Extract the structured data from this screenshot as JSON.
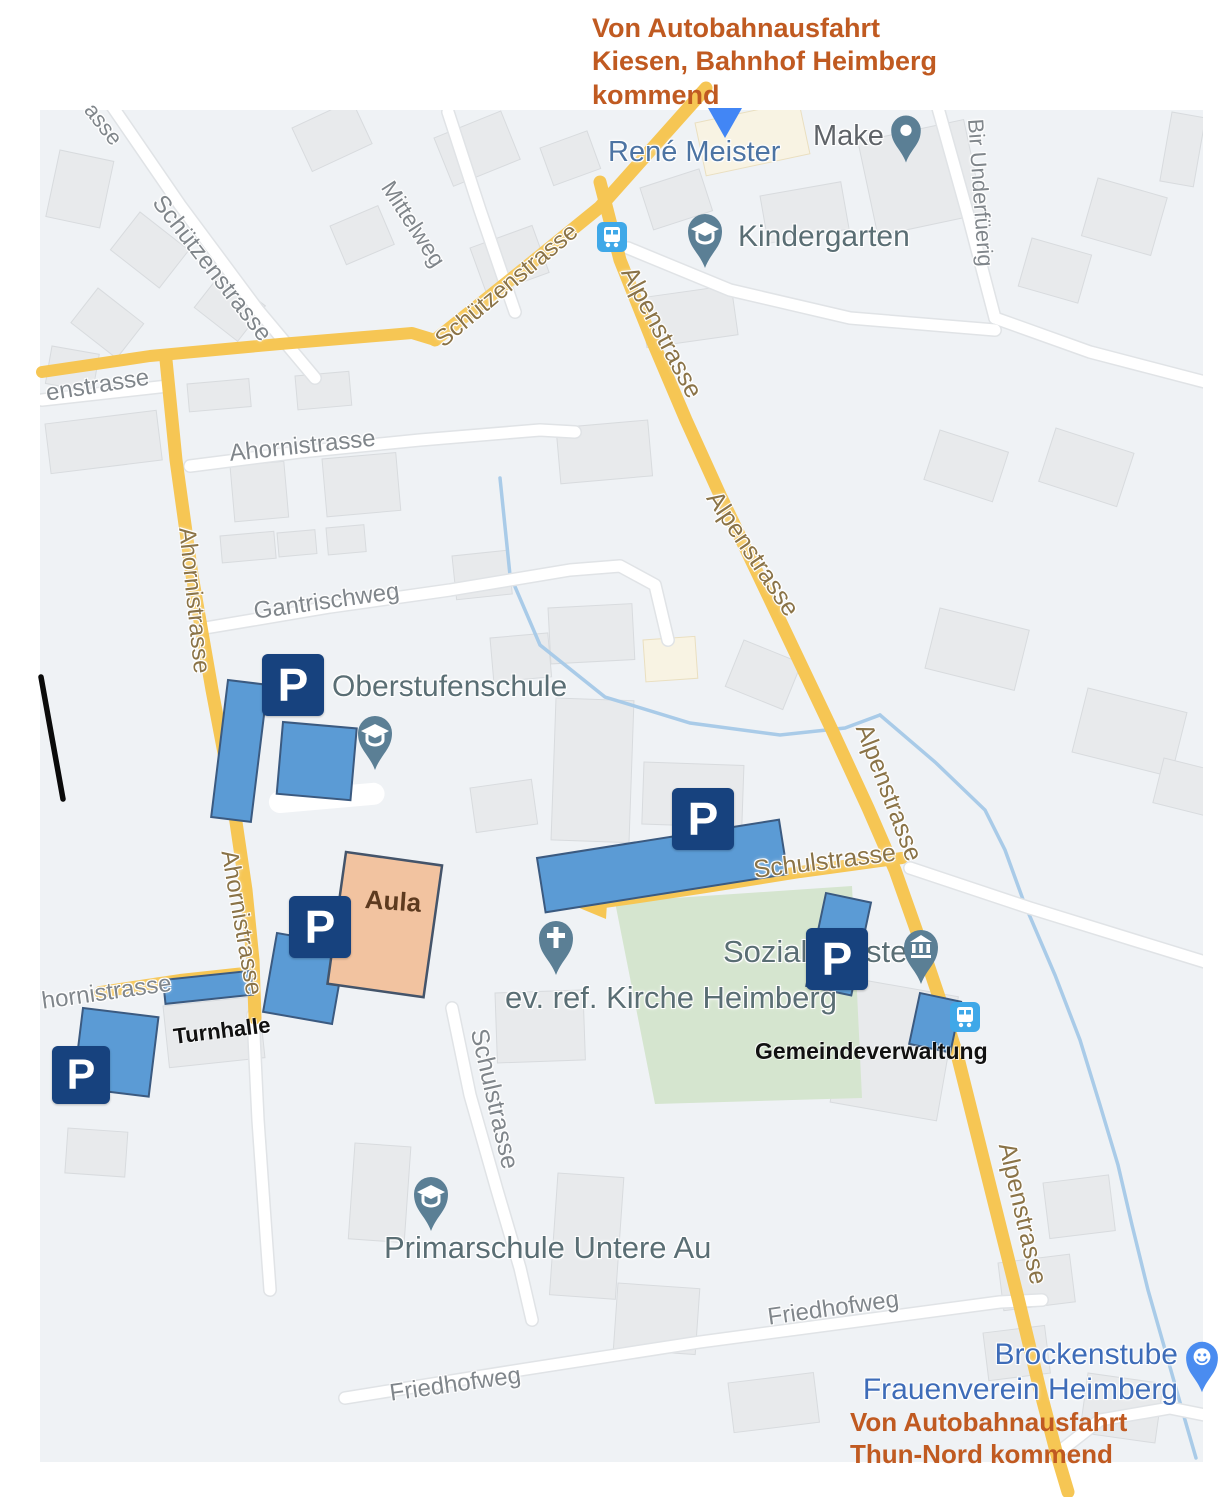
{
  "annotations": {
    "from_kiesen": {
      "lines": [
        "Von Autobahnausfahrt",
        "Kiesen, Bahnhof Heimberg",
        "kommend"
      ]
    },
    "from_thun": {
      "lines": [
        "Von Autobahnausfahrt",
        "Thun-Nord kommend"
      ]
    },
    "aula": "Aula",
    "turnhalle": "Turnhalle",
    "gemeindeverwaltung": "Gemeindeverwaltung",
    "parking_symbol": "P"
  },
  "streets": {
    "schuetzenstrasse": "Schützenstrasse",
    "mittelweg": "Mittelweg",
    "bir_underfuerig": "Bir Underfüerig",
    "ahornistrasse": "Ahornistrasse",
    "ahornistrasse_partial": "hornistrasse",
    "enstrasse_partial": "enstrasse",
    "asse_partial": "asse",
    "gantrischweg": "Gantrischweg",
    "alpenstrasse": "Alpenstrasse",
    "schulstrasse": "Schulstrasse",
    "friedhofweg": "Friedhofweg"
  },
  "places": {
    "rene_meister": "René Meister",
    "make": "Make",
    "kindergarten": "Kindergarten",
    "oberstufenschule": "Oberstufenschule",
    "ev_ref_kirche": "ev. ref. Kirche Heimberg",
    "sozialdienste": "Sozialdienste",
    "primarschule": "Primarschule Untere Au",
    "brockenstube_line1": "Brockenstube",
    "brockenstube_line2": "Frauenverein Heimberg"
  },
  "icons": {
    "parking": "P-square-sign",
    "school_pin": "graduation-cap-pin",
    "church_pin": "cross-pin",
    "government_pin": "bank-pin",
    "place_pin": "round-dot-pin",
    "shop_pin": "smiley-pin",
    "bus_stop": "bus-stop-badge",
    "route_marker": "blue-triangle"
  },
  "colors": {
    "route_yellow": "#f6c654",
    "annotation_orange": "#c05a21",
    "parking_blue": "#5b9bd5",
    "parking_border": "#3b5a80",
    "p_sign_navy": "#17427e",
    "aula_peach": "#f2c3a0",
    "poi_pin_slate": "#5b7f95",
    "street_label_gray": "#80868b",
    "road_label_brown": "#8a7347",
    "poi_label_teal": "#5a6e74",
    "business_blue": "#4d74a3",
    "brockenstube_blue": "#3e6cb8",
    "map_background": "#eff2f5",
    "building_gray": "#e8eaec",
    "green_area": "#d5e5cf",
    "stream_blue": "#a9cbe8"
  }
}
